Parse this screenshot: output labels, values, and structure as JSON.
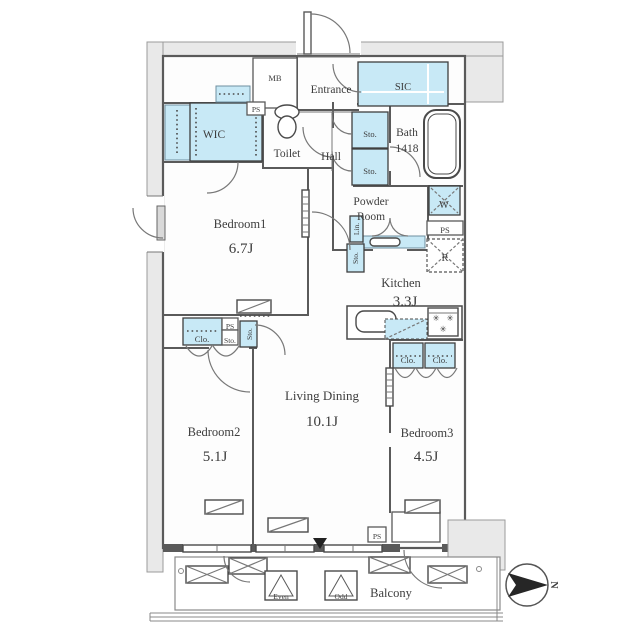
{
  "floor_plan": {
    "rooms": {
      "entrance": {
        "label": "Entrance"
      },
      "mb": {
        "label": "MB"
      },
      "sic": {
        "label": "SIC"
      },
      "wic": {
        "label": "WIC"
      },
      "toilet": {
        "label": "Toilet"
      },
      "hall": {
        "label": "Hall"
      },
      "bath": {
        "label": "Bath",
        "size": "1418"
      },
      "powder_room": {
        "label_line1": "Powder",
        "label_line2": "Room"
      },
      "kitchen": {
        "label": "Kitchen",
        "size": "3.3J"
      },
      "bedroom1": {
        "label": "Bedroom1",
        "size": "6.7J"
      },
      "bedroom2": {
        "label": "Bedroom2",
        "size": "5.1J"
      },
      "bedroom3": {
        "label": "Bedroom3",
        "size": "4.5J"
      },
      "living_dining": {
        "label": "Living Dining",
        "size": "10.1J"
      },
      "balcony": {
        "label": "Balcony"
      }
    },
    "fixtures": {
      "pipe_space": "PS",
      "storage": "Sto.",
      "closet": "Clo.",
      "linen": "Lin.",
      "washer": "W",
      "refrigerator": "R",
      "evac_hatch_even": "Even",
      "evac_hatch_odd": "Odd"
    },
    "icons": {
      "burner": "✳"
    },
    "compass": {
      "north_label": "N"
    },
    "colors": {
      "storage_fill": "#c8e9f6",
      "outer_band_fill": "#e9e9e9",
      "wall": "#5a5a5a",
      "text": "#3d3d3d"
    }
  }
}
